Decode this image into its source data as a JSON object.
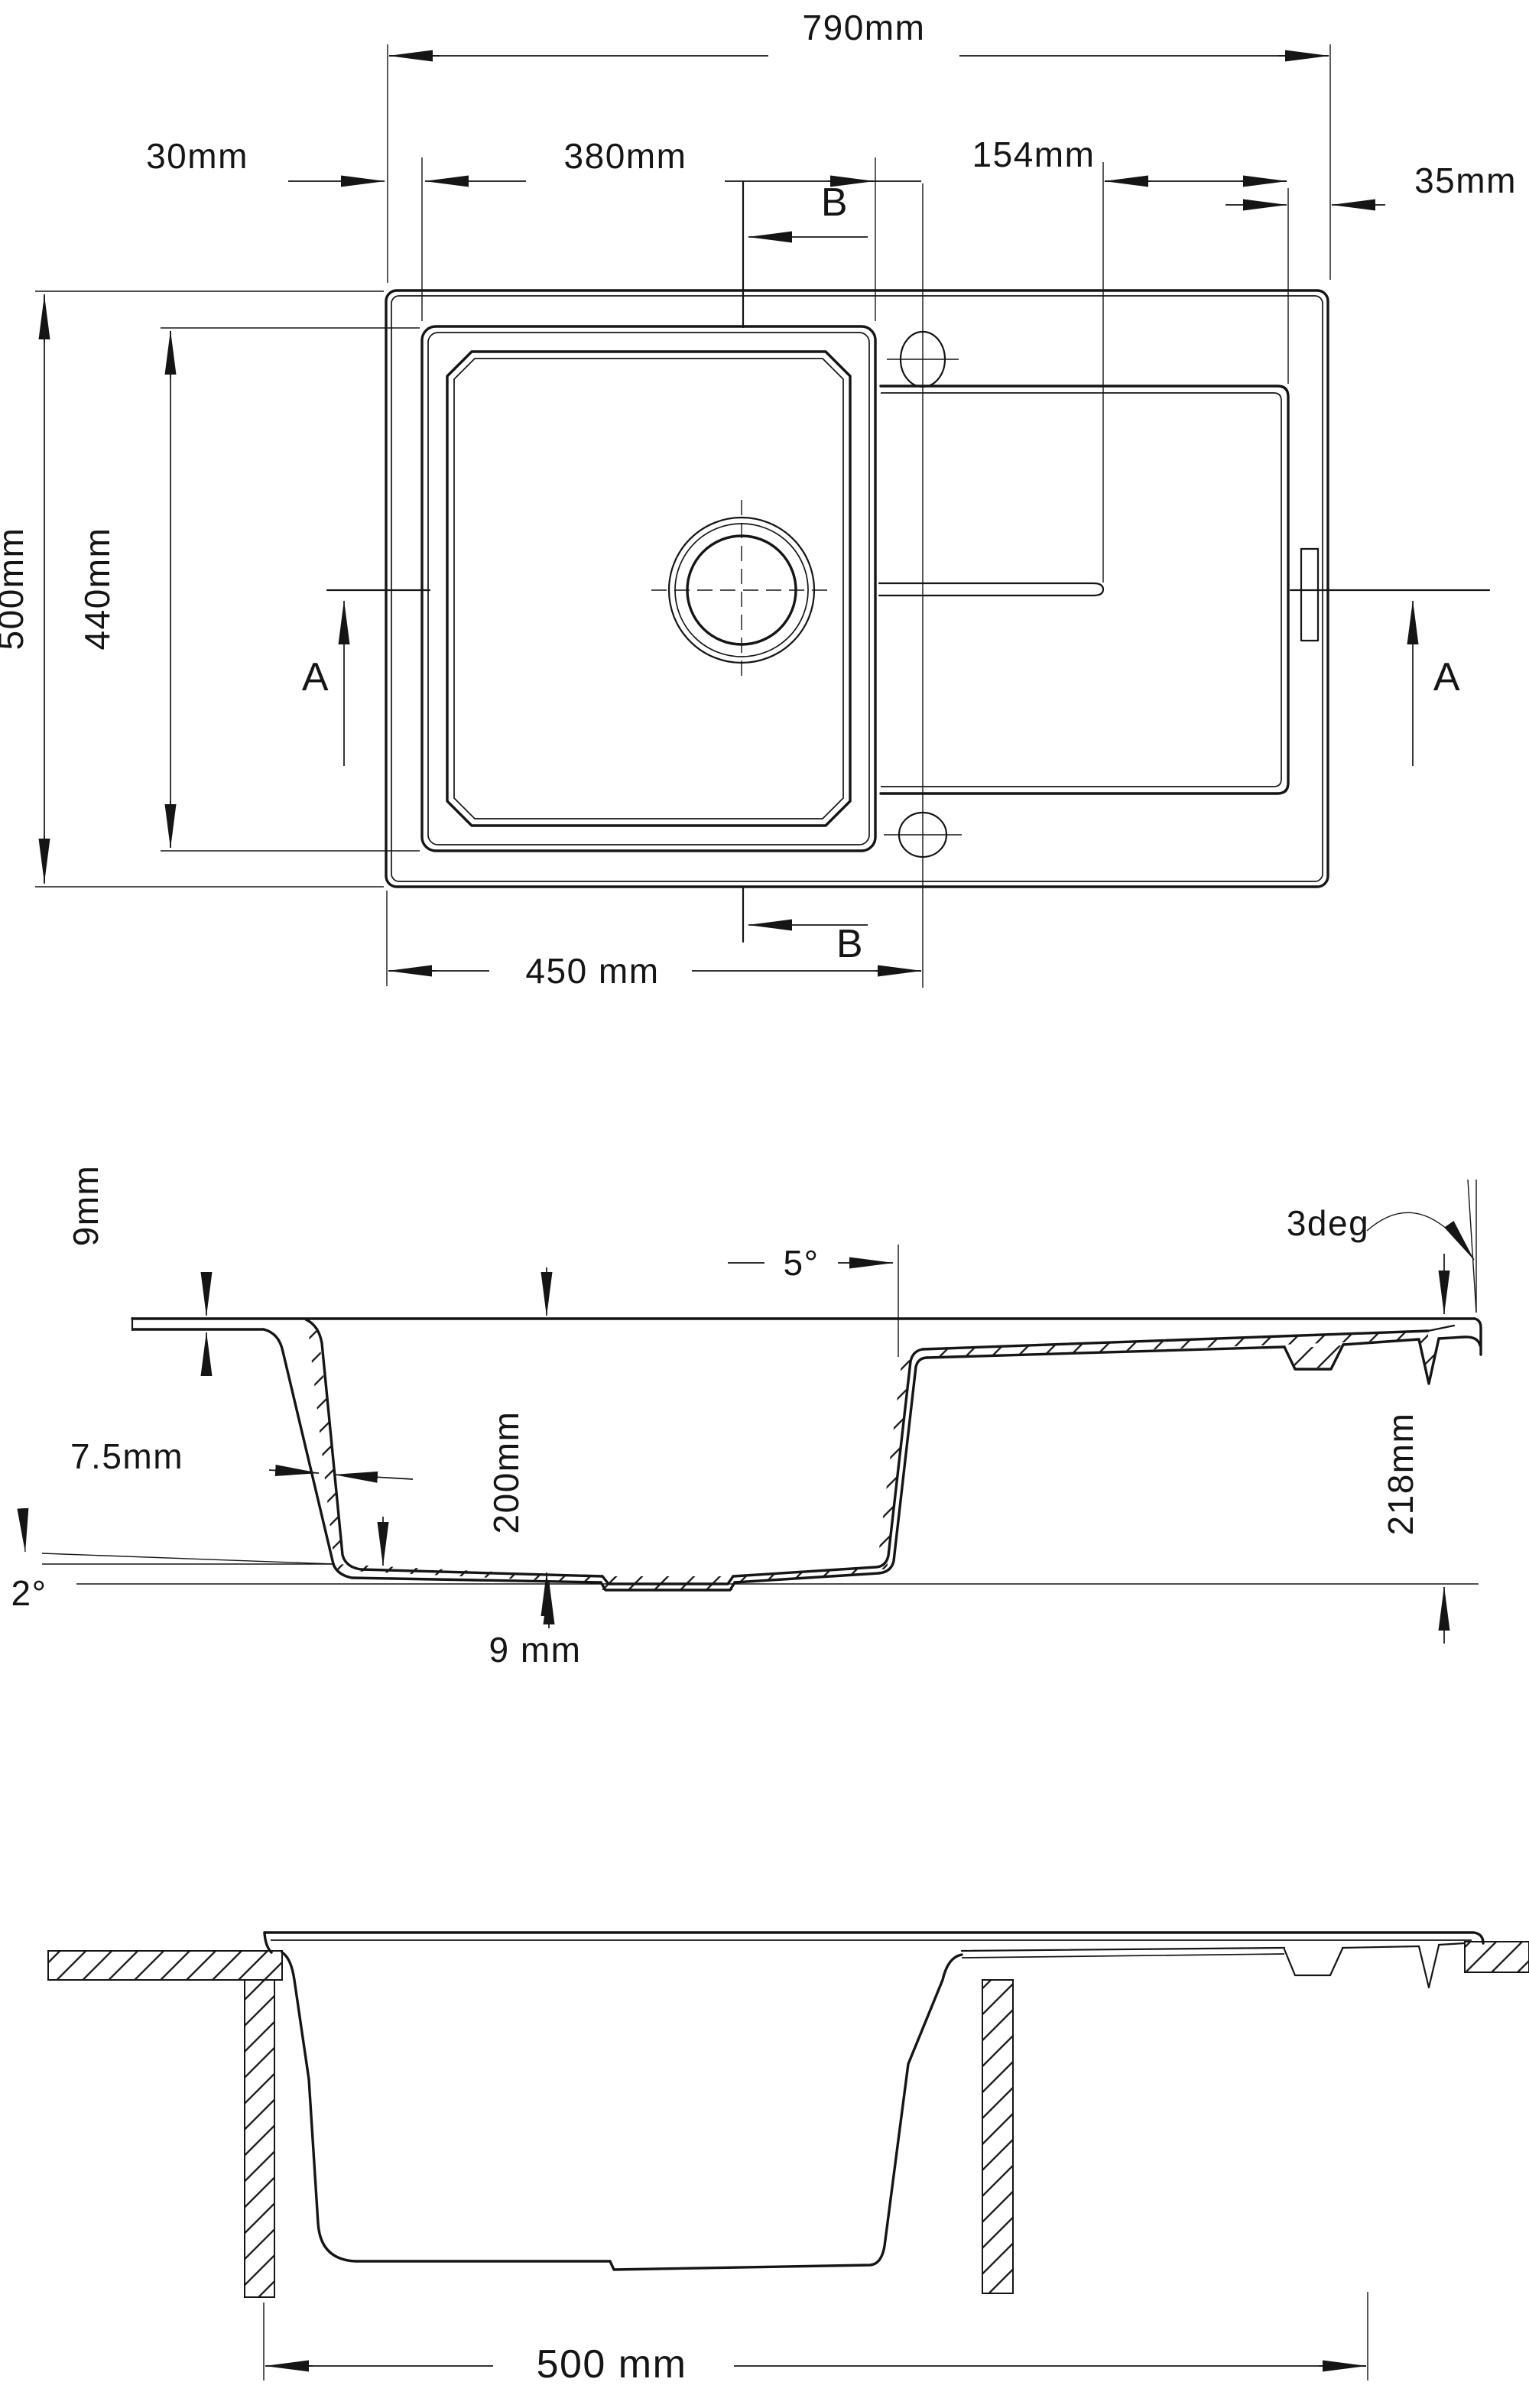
{
  "meta": {
    "drawing_type": "kitchen sink dimensioned technical drawing",
    "ink_color": "#151515",
    "background_color": "#ffffff"
  },
  "top_view": {
    "overall_width": "790mm",
    "left_offset": "30mm",
    "bowl_width": "380mm",
    "groove_offset": "154mm",
    "right_offset": "35mm",
    "overall_depth": "500mm",
    "bowl_depth": "440mm",
    "bowl_centerline": "450 mm",
    "section_a_label": "A",
    "section_b_label": "B"
  },
  "section_view": {
    "rim_thickness": "9mm",
    "wall_thickness": "7.5mm",
    "bowl_inner_depth": "200mm",
    "bottom_slope_angle": "2°",
    "bottom_thickness": "9 mm",
    "wall_draft_angle": "5°",
    "drainboard_slope_angle": "3deg",
    "overall_height": "218mm"
  },
  "installation_view": {
    "cabinet_width": "500 mm"
  }
}
